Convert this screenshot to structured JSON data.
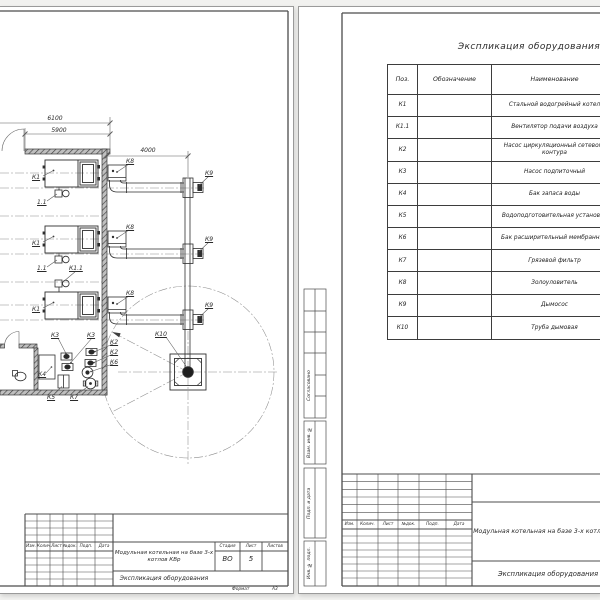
{
  "left_page": {
    "dims": {
      "width_total": "6100",
      "width_inner": "5900",
      "flue_length": "4000"
    },
    "labels": {
      "k1": "К1",
      "k1_1": "К1.1",
      "fan": "1.1",
      "k2": "К2",
      "k3": "К3",
      "k4": "К4",
      "k5": "К5",
      "k6": "К6",
      "k7": "К7",
      "k8": "К8",
      "k9": "К9",
      "k10": "К10"
    },
    "title_block": {
      "cols": [
        "Изм.",
        "Колич.",
        "Лист",
        "№док.",
        "Подп.",
        "Дата"
      ],
      "project": "Модульная котельная на базе 3-х котлов КВр",
      "doc_name": "Экспликация оборудования",
      "stage_label": "Стадия",
      "sheet_label": "Лист",
      "sheets_label": "Листов",
      "stage": "ВО",
      "sheet": "5",
      "sheets": "",
      "format_label": "Формат",
      "format_value": "А3"
    }
  },
  "right_page": {
    "table_title": "Экспликация оборудования",
    "table": {
      "headers": {
        "pos": "Поз.",
        "designation": "Обозначение",
        "name": "Наименование"
      },
      "rows": [
        {
          "pos": "К1",
          "designation": "",
          "name": "Стальной водогрейный котел"
        },
        {
          "pos": "К1.1",
          "designation": "",
          "name": "Вентилятор подачи воздуха"
        },
        {
          "pos": "К2",
          "designation": "",
          "name": "Насос циркуляционный сетевого контура"
        },
        {
          "pos": "К3",
          "designation": "",
          "name": "Насос подпиточный"
        },
        {
          "pos": "К4",
          "designation": "",
          "name": "Бак запаса воды"
        },
        {
          "pos": "К5",
          "designation": "",
          "name": "Водоподготовительная установка"
        },
        {
          "pos": "К6",
          "designation": "",
          "name": "Бак расширительный мембранный"
        },
        {
          "pos": "К7",
          "designation": "",
          "name": "Грязевой фильтр"
        },
        {
          "pos": "К8",
          "designation": "",
          "name": "Золоуловитель"
        },
        {
          "pos": "К9",
          "designation": "",
          "name": "Дымосос"
        },
        {
          "pos": "К10",
          "designation": "",
          "name": "Труба дымовая"
        }
      ]
    },
    "side_stamp": {
      "agreed": "Согласовано",
      "replace_inv": "Взам. инв. №",
      "sign_date": "Подп. и дата",
      "inv_orig": "Инв. № подл."
    },
    "title_block": {
      "cols": [
        "Изм.",
        "Колич.",
        "Лист",
        "№док.",
        "Подп.",
        "Дата"
      ],
      "project": "Модульная котельная на базе 3-х котлов КВр",
      "doc_name": "Экспликация оборудования"
    }
  }
}
